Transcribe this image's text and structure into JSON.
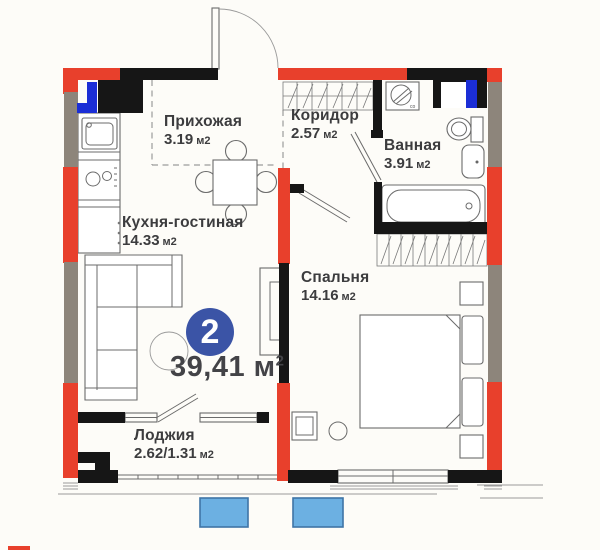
{
  "plan": {
    "type": "apartment-floor-plan",
    "badge": {
      "value": "2"
    },
    "total": {
      "value": "39,41",
      "unit": "м",
      "sup": "2"
    },
    "rooms": [
      {
        "id": "hallway",
        "name": "Прихожая",
        "area": "3.19",
        "unit": "м2"
      },
      {
        "id": "corridor",
        "name": "Коридор",
        "area": "2.57",
        "unit": "м2"
      },
      {
        "id": "bathroom",
        "name": "Ванная",
        "area": "3.91",
        "unit": "м2"
      },
      {
        "id": "kitchen-living",
        "name": "Кухня-гостиная",
        "area": "14.33",
        "unit": "м2"
      },
      {
        "id": "bedroom",
        "name": "Спальня",
        "area": "14.16",
        "unit": "м2"
      },
      {
        "id": "loggia",
        "name": "Лоджия",
        "area": "2.62/1.31",
        "unit": "м2"
      }
    ],
    "washer_label": "co",
    "colors": {
      "exterior_wall_red": "#e8402c",
      "exterior_wall_gray": "#8d857b",
      "interior_wall_black": "#161616",
      "plumbing_blue": "#1b2ed6",
      "badge_blue": "#3b54a6",
      "adjacent_balcony_fill": "#6cb0e2",
      "adjacent_balcony_border": "#3f74a6",
      "background": "#fdfcf8",
      "label_text": "#3c3c3e"
    }
  }
}
